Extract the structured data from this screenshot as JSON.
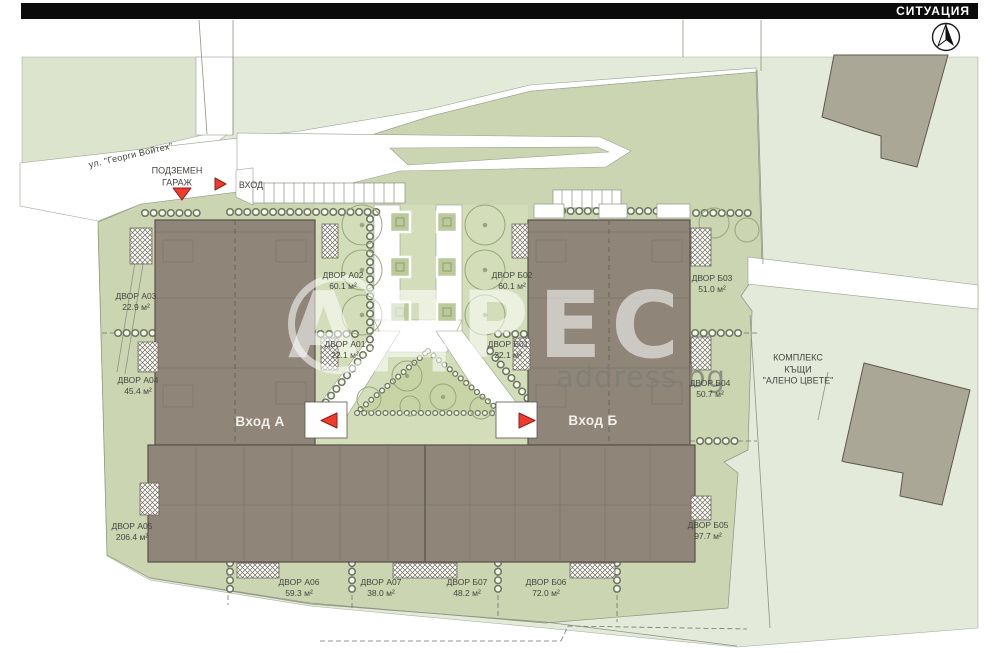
{
  "header": {
    "title": "СИТУАЦИЯ"
  },
  "watermark": {
    "brand": "АДРЕС",
    "site": "address.bg"
  },
  "labels": {
    "street": "ул. \"Георги Войтех\"",
    "garage_l1": "ПОДЗЕМЕН",
    "garage_l2": "ГАРАЖ",
    "drive_entrance": "ВХОД",
    "entrance_a": "Вход А",
    "entrance_b": "Вход Б",
    "complex_l1": "КОМПЛЕКС",
    "complex_l2": "КЪЩИ",
    "complex_l3": "\"АЛЕНО ЦВЕТЕ\""
  },
  "yards": [
    {
      "name": "ДВОР А03",
      "area": "22.9 м²"
    },
    {
      "name": "ДВОР А04",
      "area": "45.4 м²"
    },
    {
      "name": "ДВОР А05",
      "area": "206.4 м²"
    },
    {
      "name": "ДВОР А06",
      "area": "59.3 м²"
    },
    {
      "name": "ДВОР А07",
      "area": "38.0 м²"
    },
    {
      "name": "ДВОР Б07",
      "area": "48.2 м²"
    },
    {
      "name": "ДВОР Б06",
      "area": "72.0 м²"
    },
    {
      "name": "ДВОР Б05",
      "area": "97.7 м²"
    },
    {
      "name": "ДВОР Б04",
      "area": "50.7 м²"
    },
    {
      "name": "ДВОР Б03",
      "area": "51.0 м²"
    },
    {
      "name": "ДВОР Б02",
      "area": "60.1 м²"
    },
    {
      "name": "ДВОР А02",
      "area": "60.1 м²"
    },
    {
      "name": "ДВОР А01",
      "area": "22.1 м²"
    },
    {
      "name": "ДВОР Б01",
      "area": "22.1 м²"
    }
  ],
  "colors": {
    "accent_red": "#ef3b2e",
    "site_green": "#cbd5b1",
    "parcel_green": "#e4eada",
    "building_brown": "#8f8679",
    "neighbor_grey": "#aba796"
  }
}
